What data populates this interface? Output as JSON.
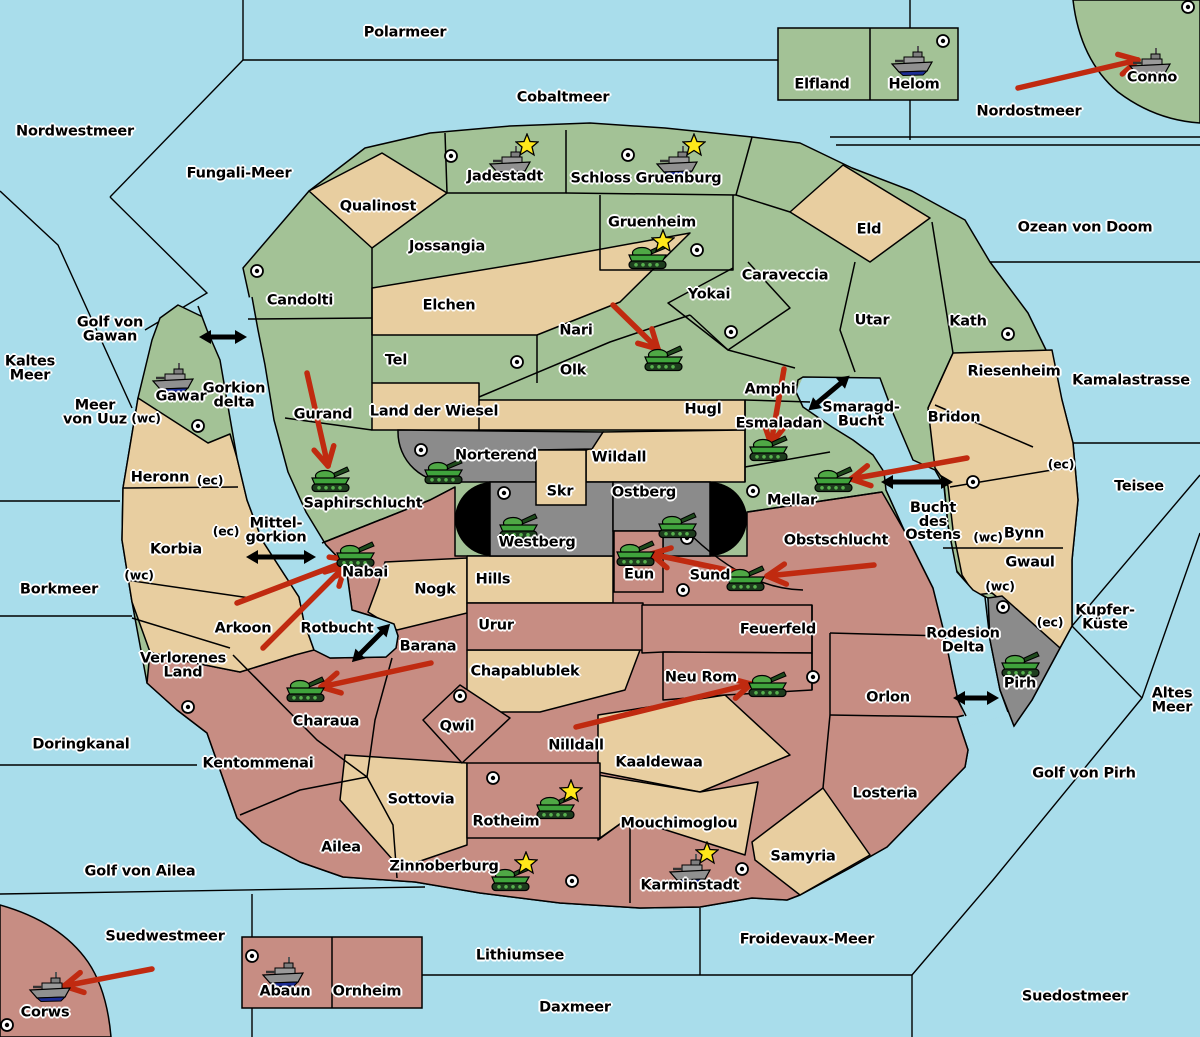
{
  "map": {
    "width": 1200,
    "height": 1037,
    "title": "strategy world map"
  },
  "colors": {
    "sea": "#A9DDEB",
    "land_green": "#A3C296",
    "land_tan": "#E8CEA0",
    "land_rose": "#C78D83",
    "land_gray": "#8B8B8B",
    "impassable_black": "#000000",
    "border": "#000000",
    "attack_arrow_red": "#C02A10",
    "strait_arrow_black": "#000000",
    "tank_green": "#3FA33C",
    "ship_gray": "#909090",
    "ship_keel_blue": "#1B2C94",
    "star_yellow": "#FFE81A",
    "city_white": "#FFFFFF"
  },
  "sea_labels": [
    {
      "text": "Polarmeer",
      "x": 405,
      "y": 33
    },
    {
      "text": "Cobaltmeer",
      "x": 563,
      "y": 98
    },
    {
      "text": "Nordwestmeer",
      "x": 75,
      "y": 132
    },
    {
      "text": "Fungali-Meer",
      "x": 239,
      "y": 174
    },
    {
      "text": "Nordostmeer",
      "x": 1029,
      "y": 112
    },
    {
      "text": "Ozean von Doom",
      "x": 1085,
      "y": 228
    },
    {
      "text": "Kaltes\nMeer",
      "x": 30,
      "y": 369
    },
    {
      "text": "Golf von\nGawan",
      "x": 110,
      "y": 330
    },
    {
      "text": "Meer\nvon Uuz",
      "x": 95,
      "y": 413
    },
    {
      "text": "Kamalastrasse",
      "x": 1131,
      "y": 381
    },
    {
      "text": "Teisee",
      "x": 1139,
      "y": 487
    },
    {
      "text": "Borkmeer",
      "x": 59,
      "y": 590
    },
    {
      "text": "Kupfer-\nKüste",
      "x": 1105,
      "y": 618
    },
    {
      "text": "Altes\nMeer",
      "x": 1172,
      "y": 701
    },
    {
      "text": "Golf von Pirh",
      "x": 1084,
      "y": 774
    },
    {
      "text": "Doringkanal",
      "x": 81,
      "y": 745
    },
    {
      "text": "Golf von Ailea",
      "x": 140,
      "y": 872
    },
    {
      "text": "Suedwestmeer",
      "x": 165,
      "y": 937
    },
    {
      "text": "Lithiumsee",
      "x": 520,
      "y": 956
    },
    {
      "text": "Froidevaux-Meer",
      "x": 807,
      "y": 940
    },
    {
      "text": "Daxmeer",
      "x": 575,
      "y": 1008
    },
    {
      "text": "Suedostmeer",
      "x": 1075,
      "y": 997
    },
    {
      "text": "Smaragd-\nBucht",
      "x": 861,
      "y": 415
    },
    {
      "text": "Bucht\ndes\nOstens",
      "x": 933,
      "y": 522
    },
    {
      "text": "Mittel-\ngorkion",
      "x": 276,
      "y": 531
    },
    {
      "text": "Gorkion\ndelta",
      "x": 234,
      "y": 396
    },
    {
      "text": "Rotbucht",
      "x": 337,
      "y": 629
    },
    {
      "text": "Rodesion\nDelta",
      "x": 963,
      "y": 641
    }
  ],
  "region_labels": [
    {
      "text": "Elfland",
      "x": 822,
      "y": 85
    },
    {
      "text": "Helom",
      "x": 914,
      "y": 85
    },
    {
      "text": "Conno",
      "x": 1152,
      "y": 78
    },
    {
      "text": "Jadestadt",
      "x": 505,
      "y": 177
    },
    {
      "text": "Schloss Gruenburg",
      "x": 646,
      "y": 179
    },
    {
      "text": "Qualinost",
      "x": 378,
      "y": 207
    },
    {
      "text": "Jossangia",
      "x": 447,
      "y": 247
    },
    {
      "text": "Gruenheim",
      "x": 652,
      "y": 223
    },
    {
      "text": "Eld",
      "x": 869,
      "y": 230
    },
    {
      "text": "Caraveccia",
      "x": 785,
      "y": 276
    },
    {
      "text": "Candolti",
      "x": 300,
      "y": 301
    },
    {
      "text": "Elchen",
      "x": 449,
      "y": 306
    },
    {
      "text": "Yokai",
      "x": 709,
      "y": 295
    },
    {
      "text": "Nari",
      "x": 576,
      "y": 331
    },
    {
      "text": "Utar",
      "x": 872,
      "y": 321
    },
    {
      "text": "Kath",
      "x": 968,
      "y": 322
    },
    {
      "text": "Tel",
      "x": 396,
      "y": 361
    },
    {
      "text": "Olk",
      "x": 573,
      "y": 371
    },
    {
      "text": "Gurand",
      "x": 323,
      "y": 415
    },
    {
      "text": "Amphi",
      "x": 770,
      "y": 390
    },
    {
      "text": "Hugl",
      "x": 703,
      "y": 410
    },
    {
      "text": "Esmaladan",
      "x": 779,
      "y": 424
    },
    {
      "text": "Mellar",
      "x": 792,
      "y": 501
    },
    {
      "text": "Gawar",
      "x": 181,
      "y": 397
    },
    {
      "text": "Land der Wiesel",
      "x": 434,
      "y": 412
    },
    {
      "text": "Wildall",
      "x": 619,
      "y": 458
    },
    {
      "text": "Skr",
      "x": 560,
      "y": 492
    },
    {
      "text": "Riesenheim",
      "x": 1014,
      "y": 372
    },
    {
      "text": "Bridon",
      "x": 954,
      "y": 418
    },
    {
      "text": "Bynn",
      "x": 1024,
      "y": 534
    },
    {
      "text": "Gwaul",
      "x": 1030,
      "y": 563
    },
    {
      "text": "Heronn",
      "x": 160,
      "y": 478
    },
    {
      "text": "Korbia",
      "x": 176,
      "y": 550
    },
    {
      "text": "Arkoon",
      "x": 243,
      "y": 629
    },
    {
      "text": "Verlorenes\nLand",
      "x": 183,
      "y": 666
    },
    {
      "text": "Saphirschlucht",
      "x": 363,
      "y": 504
    },
    {
      "text": "Norterend",
      "x": 496,
      "y": 456
    },
    {
      "text": "Westberg",
      "x": 537,
      "y": 543
    },
    {
      "text": "Ostberg",
      "x": 644,
      "y": 493
    },
    {
      "text": "Nabai",
      "x": 365,
      "y": 573
    },
    {
      "text": "Eun",
      "x": 639,
      "y": 575
    },
    {
      "text": "Sund",
      "x": 710,
      "y": 576
    },
    {
      "text": "Obstschlucht",
      "x": 836,
      "y": 541
    },
    {
      "text": "Nogk",
      "x": 435,
      "y": 590
    },
    {
      "text": "Hills",
      "x": 493,
      "y": 580
    },
    {
      "text": "Urur",
      "x": 496,
      "y": 626
    },
    {
      "text": "Chapablublek",
      "x": 525,
      "y": 672
    },
    {
      "text": "Barana",
      "x": 428,
      "y": 647
    },
    {
      "text": "Feuerfeld",
      "x": 778,
      "y": 630
    },
    {
      "text": "Neu Rom",
      "x": 701,
      "y": 678
    },
    {
      "text": "Kaaldewaa",
      "x": 659,
      "y": 763
    },
    {
      "text": "Nilldall",
      "x": 576,
      "y": 746
    },
    {
      "text": "Qwil",
      "x": 457,
      "y": 727
    },
    {
      "text": "Sottovia",
      "x": 421,
      "y": 800
    },
    {
      "text": "Rotheim",
      "x": 506,
      "y": 822
    },
    {
      "text": "Mouchimoglou",
      "x": 679,
      "y": 824
    },
    {
      "text": "Zinnoberburg",
      "x": 444,
      "y": 867
    },
    {
      "text": "Karminstadt",
      "x": 690,
      "y": 886
    },
    {
      "text": "Samyria",
      "x": 803,
      "y": 857
    },
    {
      "text": "Losteria",
      "x": 885,
      "y": 794
    },
    {
      "text": "Orlon",
      "x": 888,
      "y": 698
    },
    {
      "text": "Pirh",
      "x": 1020,
      "y": 684
    },
    {
      "text": "Kentommenai",
      "x": 258,
      "y": 764
    },
    {
      "text": "Ailea",
      "x": 341,
      "y": 848
    },
    {
      "text": "Charaua",
      "x": 326,
      "y": 722
    },
    {
      "text": "Corws",
      "x": 45,
      "y": 1013
    },
    {
      "text": "Abaun",
      "x": 285,
      "y": 992
    },
    {
      "text": "Ornheim",
      "x": 367,
      "y": 992
    }
  ],
  "passage_labels": [
    {
      "text": "(wc)",
      "x": 146,
      "y": 418
    },
    {
      "text": "(ec)",
      "x": 210,
      "y": 480
    },
    {
      "text": "(ec)",
      "x": 226,
      "y": 531
    },
    {
      "text": "(wc)",
      "x": 139,
      "y": 575
    },
    {
      "text": "(ec)",
      "x": 1061,
      "y": 464
    },
    {
      "text": "(wc)",
      "x": 988,
      "y": 537
    },
    {
      "text": "(wc)",
      "x": 1000,
      "y": 586
    },
    {
      "text": "(ec)",
      "x": 1050,
      "y": 622
    }
  ],
  "cities": [
    {
      "x": 257,
      "y": 271
    },
    {
      "x": 451,
      "y": 156
    },
    {
      "x": 628,
      "y": 155
    },
    {
      "x": 943,
      "y": 41
    },
    {
      "x": 1188,
      "y": 7
    },
    {
      "x": 697,
      "y": 250
    },
    {
      "x": 731,
      "y": 332
    },
    {
      "x": 517,
      "y": 362
    },
    {
      "x": 198,
      "y": 426
    },
    {
      "x": 1008,
      "y": 334
    },
    {
      "x": 753,
      "y": 491
    },
    {
      "x": 421,
      "y": 450
    },
    {
      "x": 504,
      "y": 493
    },
    {
      "x": 687,
      "y": 538
    },
    {
      "x": 683,
      "y": 590
    },
    {
      "x": 973,
      "y": 482
    },
    {
      "x": 1003,
      "y": 607
    },
    {
      "x": 188,
      "y": 707
    },
    {
      "x": 460,
      "y": 696
    },
    {
      "x": 493,
      "y": 778
    },
    {
      "x": 572,
      "y": 881
    },
    {
      "x": 742,
      "y": 869
    },
    {
      "x": 252,
      "y": 956
    },
    {
      "x": 7,
      "y": 1025
    },
    {
      "x": 813,
      "y": 677
    }
  ],
  "units": {
    "tanks": [
      {
        "x": 647,
        "y": 255,
        "star": true
      },
      {
        "x": 663,
        "y": 357,
        "star": false
      },
      {
        "x": 330,
        "y": 478,
        "star": false
      },
      {
        "x": 768,
        "y": 447,
        "star": false
      },
      {
        "x": 443,
        "y": 470,
        "star": false
      },
      {
        "x": 518,
        "y": 525,
        "star": false
      },
      {
        "x": 677,
        "y": 524,
        "star": false
      },
      {
        "x": 635,
        "y": 552,
        "star": false
      },
      {
        "x": 745,
        "y": 577,
        "star": false
      },
      {
        "x": 833,
        "y": 478,
        "star": false
      },
      {
        "x": 355,
        "y": 553,
        "star": false
      },
      {
        "x": 305,
        "y": 688,
        "star": false
      },
      {
        "x": 767,
        "y": 683,
        "star": false
      },
      {
        "x": 555,
        "y": 805,
        "star": true
      },
      {
        "x": 510,
        "y": 877,
        "star": true
      },
      {
        "x": 1020,
        "y": 663,
        "star": false
      }
    ],
    "ships": [
      {
        "x": 510,
        "y": 160,
        "star": true
      },
      {
        "x": 677,
        "y": 160,
        "star": true
      },
      {
        "x": 912,
        "y": 60,
        "star": false
      },
      {
        "x": 1150,
        "y": 62,
        "star": false
      },
      {
        "x": 173,
        "y": 377,
        "star": false
      },
      {
        "x": 690,
        "y": 868,
        "star": true
      },
      {
        "x": 283,
        "y": 971,
        "star": false
      },
      {
        "x": 50,
        "y": 986,
        "star": false
      }
    ]
  },
  "red_arrows": [
    {
      "x1": 1018,
      "y1": 88,
      "x2": 1138,
      "y2": 60
    },
    {
      "x1": 613,
      "y1": 305,
      "x2": 658,
      "y2": 349
    },
    {
      "x1": 307,
      "y1": 373,
      "x2": 328,
      "y2": 466
    },
    {
      "x1": 784,
      "y1": 369,
      "x2": 771,
      "y2": 444
    },
    {
      "x1": 967,
      "y1": 458,
      "x2": 851,
      "y2": 479
    },
    {
      "x1": 237,
      "y1": 603,
      "x2": 350,
      "y2": 560
    },
    {
      "x1": 263,
      "y1": 648,
      "x2": 345,
      "y2": 566
    },
    {
      "x1": 874,
      "y1": 565,
      "x2": 767,
      "y2": 576
    },
    {
      "x1": 741,
      "y1": 573,
      "x2": 651,
      "y2": 554
    },
    {
      "x1": 576,
      "y1": 727,
      "x2": 751,
      "y2": 684
    },
    {
      "x1": 431,
      "y1": 663,
      "x2": 321,
      "y2": 687
    },
    {
      "x1": 152,
      "y1": 969,
      "x2": 64,
      "y2": 986
    }
  ],
  "strait_arrows": [
    {
      "x": 223,
      "y": 337,
      "angle": 0,
      "length": 30
    },
    {
      "x": 281,
      "y": 557,
      "angle": 0,
      "length": 52
    },
    {
      "x": 829,
      "y": 393,
      "angle": -40,
      "length": 36
    },
    {
      "x": 917,
      "y": 482,
      "angle": 0,
      "length": 54
    },
    {
      "x": 371,
      "y": 643,
      "angle": -45,
      "length": 36
    },
    {
      "x": 976,
      "y": 698,
      "angle": 0,
      "length": 28
    }
  ]
}
